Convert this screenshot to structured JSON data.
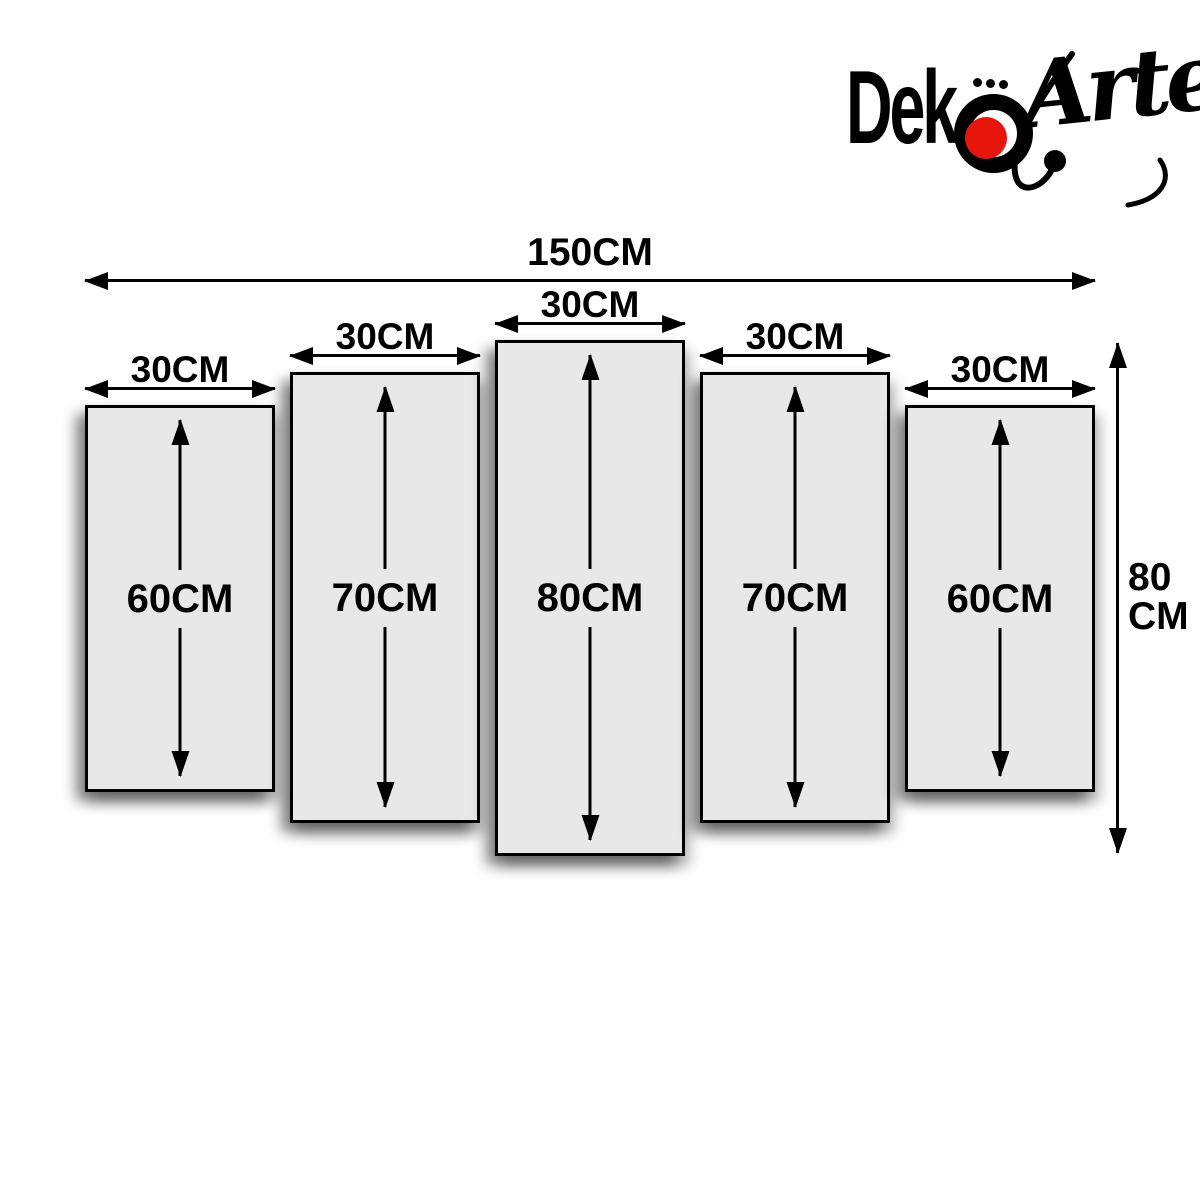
{
  "brand": {
    "name": "DekoArte",
    "logo_text_bold": "Dek",
    "logo_umlaut_letter": "ö",
    "logo_text_script": "Arte"
  },
  "overall": {
    "width_label": "150CM",
    "height_label_line1": "80",
    "height_label_line2": "CM"
  },
  "panels": [
    {
      "width_label": "30CM",
      "height_label": "60CM"
    },
    {
      "width_label": "30CM",
      "height_label": "70CM"
    },
    {
      "width_label": "30CM",
      "height_label": "80CM"
    },
    {
      "width_label": "30CM",
      "height_label": "70CM"
    },
    {
      "width_label": "30CM",
      "height_label": "60CM"
    }
  ],
  "colors": {
    "background": "#ffffff",
    "panel_fill": "#e8e8e8",
    "line": "#000000",
    "logo_red": "#e8150d"
  }
}
